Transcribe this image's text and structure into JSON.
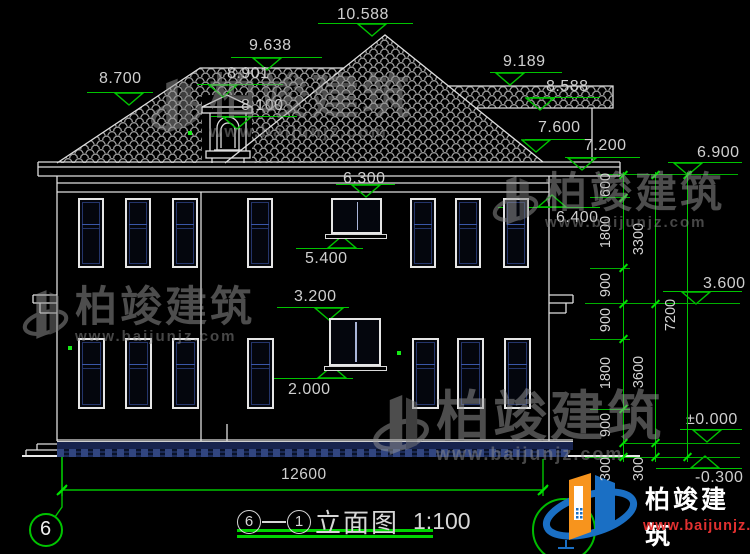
{
  "drawing": {
    "sheet_number": "6",
    "axis_left": "6",
    "axis_right": "1",
    "title": "立面图",
    "scale": "1:100",
    "total_width_dim": "12600"
  },
  "colors": {
    "line": "#dedede",
    "green": "#00c400",
    "navy": "#24356b",
    "tile_gray": "#8f8f8f",
    "logo_orange": "#f7941d",
    "logo_blue": "#1a6fc4",
    "logo_red": "#e03030"
  },
  "levels": [
    {
      "label": "10.588",
      "tx": 337,
      "ty": 6,
      "lx1": 318,
      "lx2": 413,
      "ly": 23,
      "tip": 372,
      "dir": "down"
    },
    {
      "label": "9.638",
      "tx": 249,
      "ty": 37,
      "lx1": 231,
      "lx2": 322,
      "ly": 57,
      "tip": 267,
      "dir": "down"
    },
    {
      "label": "8.901",
      "tx": 227,
      "ty": 65,
      "lx1": 197,
      "lx2": 283,
      "ly": 84,
      "tip": 223,
      "dir": "down"
    },
    {
      "label": "8.100",
      "tx": 241,
      "ty": 97,
      "lx1": 211,
      "lx2": 297,
      "ly": 116,
      "tip": 237,
      "dir": "down"
    },
    {
      "label": "8.700",
      "tx": 99,
      "ty": 70,
      "lx1": 87,
      "lx2": 153,
      "ly": 92,
      "tip": 129,
      "dir": "down"
    },
    {
      "label": "9.189",
      "tx": 503,
      "ty": 53,
      "lx1": 490,
      "lx2": 562,
      "ly": 72,
      "tip": 510,
      "dir": "down"
    },
    {
      "label": "8.588",
      "tx": 546,
      "ty": 78,
      "lx1": 530,
      "lx2": 600,
      "ly": 97,
      "tip": 540,
      "dir": "down"
    },
    {
      "label": "7.600",
      "tx": 538,
      "ty": 119,
      "lx1": 525,
      "lx2": 592,
      "ly": 139,
      "tip": 536,
      "dir": "down"
    },
    {
      "label": "7.200",
      "tx": 584,
      "ty": 137,
      "lx1": 565,
      "lx2": 640,
      "ly": 157,
      "tip": 582,
      "dir": "down"
    },
    {
      "label": "6.900",
      "tx": 697,
      "ty": 144,
      "lx1": 668,
      "lx2": 742,
      "ly": 162,
      "tip": 688,
      "dir": "down"
    },
    {
      "label": "6.300",
      "tx": 343,
      "ty": 170,
      "lx1": 336,
      "lx2": 395,
      "ly": 184,
      "tip": 366,
      "dir": "down"
    },
    {
      "label": "5.400",
      "tx": 305,
      "ty": 250,
      "lx1": 296,
      "lx2": 363,
      "ly": 248,
      "tip": 342,
      "dir": "up"
    },
    {
      "label": "6.400",
      "tx": 556,
      "ty": 209,
      "lx1": 498,
      "lx2": 600,
      "ly": 207,
      "tip": 552,
      "dir": "up"
    },
    {
      "label": "3.600",
      "tx": 703,
      "ty": 275,
      "lx1": 663,
      "lx2": 742,
      "ly": 291,
      "tip": 696,
      "dir": "down"
    },
    {
      "label": "3.200",
      "tx": 294,
      "ty": 288,
      "lx1": 277,
      "lx2": 349,
      "ly": 307,
      "tip": 329,
      "dir": "down"
    },
    {
      "label": "2.000",
      "tx": 288,
      "ty": 381,
      "lx1": 271,
      "lx2": 353,
      "ly": 378,
      "tip": 332,
      "dir": "up"
    },
    {
      "label": "±0.000",
      "tx": 686,
      "ty": 411,
      "lx1": 680,
      "lx2": 742,
      "ly": 429,
      "tip": 707,
      "dir": "down"
    },
    {
      "label": "-0.300",
      "tx": 695,
      "ty": 469,
      "lx1": 656,
      "lx2": 742,
      "ly": 468,
      "tip": 705,
      "dir": "up"
    }
  ],
  "chains": {
    "verticals": [
      {
        "x": 623,
        "y1": 172,
        "y2": 462
      },
      {
        "x": 655,
        "y1": 172,
        "y2": 462
      },
      {
        "x": 687,
        "y1": 172,
        "y2": 462
      }
    ],
    "extensions": [
      {
        "y": 174,
        "x1": 598,
        "x2": 738
      },
      {
        "y": 197,
        "x1": 590,
        "x2": 630
      },
      {
        "y": 268,
        "x1": 590,
        "x2": 630
      },
      {
        "y": 303,
        "x1": 585,
        "x2": 740
      },
      {
        "y": 339,
        "x1": 590,
        "x2": 630
      },
      {
        "y": 409,
        "x1": 590,
        "x2": 630
      },
      {
        "y": 443,
        "x1": 623,
        "x2": 740
      },
      {
        "y": 457,
        "x1": 585,
        "x2": 740
      }
    ],
    "ticks": [
      {
        "x": 623,
        "y": 175
      },
      {
        "x": 623,
        "y": 198
      },
      {
        "x": 623,
        "y": 268
      },
      {
        "x": 623,
        "y": 304
      },
      {
        "x": 623,
        "y": 339
      },
      {
        "x": 623,
        "y": 409
      },
      {
        "x": 623,
        "y": 443
      },
      {
        "x": 623,
        "y": 457
      },
      {
        "x": 655,
        "y": 175
      },
      {
        "x": 655,
        "y": 304
      },
      {
        "x": 655,
        "y": 443
      },
      {
        "x": 655,
        "y": 457
      },
      {
        "x": 687,
        "y": 175
      },
      {
        "x": 687,
        "y": 457
      },
      {
        "x": 62,
        "y": 490
      },
      {
        "x": 543,
        "y": 490
      }
    ],
    "labels": [
      {
        "t": "600",
        "x": 606,
        "y": 186
      },
      {
        "t": "1800",
        "x": 606,
        "y": 233
      },
      {
        "t": "900",
        "x": 606,
        "y": 286
      },
      {
        "t": "900",
        "x": 606,
        "y": 321
      },
      {
        "t": "1800",
        "x": 606,
        "y": 374
      },
      {
        "t": "900",
        "x": 606,
        "y": 426
      },
      {
        "t": "300",
        "x": 606,
        "y": 470
      },
      {
        "t": "3300",
        "x": 639,
        "y": 240
      },
      {
        "t": "3600",
        "x": 639,
        "y": 373
      },
      {
        "t": "300",
        "x": 639,
        "y": 470
      },
      {
        "t": "7200",
        "x": 671,
        "y": 316
      }
    ]
  },
  "bottom_dim": {
    "label": "12600",
    "text_x": 281,
    "text_y": 466
  },
  "windows": {
    "floors": [
      {
        "y": 198,
        "h": 70,
        "w": 26,
        "transom": 24,
        "xs": [
          78,
          125,
          172,
          247,
          410,
          455,
          503
        ]
      },
      {
        "y": 338,
        "h": 71,
        "w": 27,
        "transom": 24,
        "xs": [
          78,
          125,
          172,
          247,
          412,
          457,
          504
        ]
      }
    ],
    "small": [
      {
        "x": 331,
        "y": 198,
        "w": 51,
        "h": 36,
        "sill_x": 325,
        "sill_y": 234,
        "sill_w": 62
      },
      {
        "x": 329,
        "y": 318,
        "w": 52,
        "h": 48,
        "sill_x": 324,
        "sill_y": 366,
        "sill_w": 63
      }
    ]
  },
  "watermarks": [
    {
      "x": 150,
      "y": 74,
      "cn": "柏竣建筑",
      "url": "www.baijunjz.com",
      "cn_size": 48,
      "url_size": 17
    },
    {
      "x": 22,
      "y": 286,
      "cn": "柏竣建筑",
      "url": "www.baijunjz.com",
      "cn_size": 42,
      "url_size": 15
    },
    {
      "x": 492,
      "y": 172,
      "cn": "柏竣建筑",
      "url": "www.baijunjz.com",
      "cn_size": 42,
      "url_size": 15
    },
    {
      "x": 372,
      "y": 390,
      "cn": "柏竣建筑",
      "url": "www.baijunjz.com",
      "cn_size": 54,
      "url_size": 18
    }
  ],
  "brand": {
    "cn": "柏竣建筑",
    "url": "www.baijunjz.com"
  },
  "green_dots": [
    {
      "x": 188,
      "y": 131
    },
    {
      "x": 68,
      "y": 346
    },
    {
      "x": 397,
      "y": 351
    }
  ]
}
